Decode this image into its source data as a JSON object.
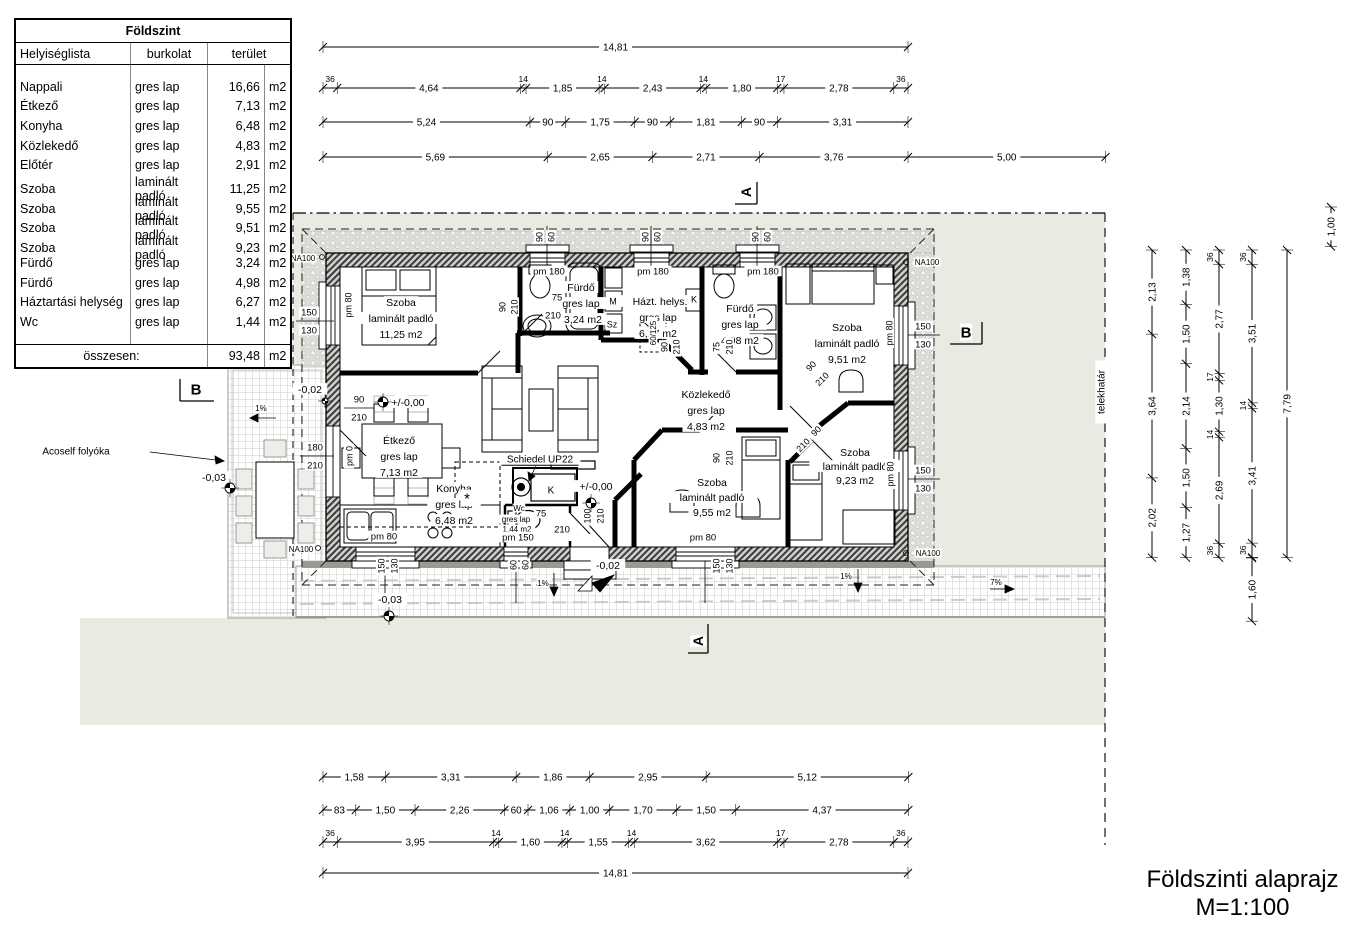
{
  "drawing": {
    "title": "Földszinti alaprajz",
    "scale_note": "M=1:100"
  },
  "schedule": {
    "title": "Földszint",
    "columns": [
      "Helyiséglista",
      "burkolat",
      "terület"
    ],
    "unit": "m2",
    "rows": [
      [
        "Nappali",
        "gres lap",
        "16,66"
      ],
      [
        "Étkező",
        "gres lap",
        "7,13"
      ],
      [
        "Konyha",
        "gres lap",
        "6,48"
      ],
      [
        "Közlekedő",
        "gres lap",
        "4,83"
      ],
      [
        "Előtér",
        "gres lap",
        "2,91"
      ],
      [
        "Szoba",
        "laminált padló",
        "11,25"
      ],
      [
        "Szoba",
        "laminált padló",
        "9,55"
      ],
      [
        "Szoba",
        "laminált padló",
        "9,51"
      ],
      [
        "Szoba",
        "laminált padló",
        "9,23"
      ],
      [
        "Fürdő",
        "gres lap",
        "3,24"
      ],
      [
        "Fürdő",
        "gres lap",
        "4,98"
      ],
      [
        "Háztartási helység",
        "gres lap",
        "6,27"
      ],
      [
        "Wc",
        "gres lap",
        "1,44"
      ]
    ],
    "total_label": "összesen:",
    "total_value": "93,48"
  },
  "colors": {
    "site": "#e9ebe2",
    "paper": "#ffffff",
    "line": "#000000"
  },
  "plan": {
    "scale_px_per_m": 39.5,
    "chains": [
      {
        "n": "top-overall",
        "d": "h",
        "x": 323,
        "y": 47,
        "segs": [
          [
            14.81,
            "14,81"
          ]
        ]
      },
      {
        "n": "top-openings",
        "d": "h",
        "x": 323,
        "y": 88,
        "segs": [
          [
            0.36,
            "36"
          ],
          [
            4.64,
            "4,64"
          ],
          [
            0.14,
            "14"
          ],
          [
            1.85,
            "1,85"
          ],
          [
            0.14,
            "14"
          ],
          [
            2.43,
            "2,43"
          ],
          [
            0.14,
            "14"
          ],
          [
            1.8,
            "1,80"
          ],
          [
            0.17,
            "17"
          ],
          [
            2.78,
            "2,78"
          ],
          [
            0.36,
            "36"
          ]
        ]
      },
      {
        "n": "top-axes",
        "d": "h",
        "x": 323,
        "y": 122,
        "segs": [
          [
            5.24,
            "5,24"
          ],
          [
            0.9,
            "90"
          ],
          [
            1.75,
            "1,75"
          ],
          [
            0.9,
            "90"
          ],
          [
            1.81,
            "1,81"
          ],
          [
            0.9,
            "90"
          ],
          [
            3.31,
            "3,31"
          ]
        ]
      },
      {
        "n": "top-site",
        "d": "h",
        "x": 323,
        "y": 157,
        "segs": [
          [
            5.69,
            "5,69"
          ],
          [
            2.65,
            "2,65"
          ],
          [
            2.71,
            "2,71"
          ],
          [
            3.76,
            "3,76"
          ],
          [
            5.0,
            "5,00"
          ]
        ]
      },
      {
        "n": "bottom-rooms",
        "d": "h",
        "x": 323,
        "y": 777,
        "segs": [
          [
            1.58,
            "1,58"
          ],
          [
            3.31,
            "3,31"
          ],
          [
            1.86,
            "1,86"
          ],
          [
            2.95,
            "2,95"
          ],
          [
            5.12,
            "5,12"
          ]
        ]
      },
      {
        "n": "bottom-openings",
        "d": "h",
        "x": 323,
        "y": 810,
        "segs": [
          [
            0.83,
            "83"
          ],
          [
            1.5,
            "1,50"
          ],
          [
            2.26,
            "2,26"
          ],
          [
            0.6,
            "60"
          ],
          [
            1.06,
            "1,06"
          ],
          [
            1.0,
            "1,00"
          ],
          [
            1.7,
            "1,70"
          ],
          [
            1.5,
            "1,50"
          ],
          [
            4.37,
            "4,37"
          ]
        ]
      },
      {
        "n": "bottom-walls",
        "d": "h",
        "x": 323,
        "y": 842,
        "segs": [
          [
            0.36,
            "36"
          ],
          [
            3.95,
            "3,95"
          ],
          [
            0.14,
            "14"
          ],
          [
            1.6,
            "1,60"
          ],
          [
            0.14,
            "14"
          ],
          [
            1.55,
            "1,55"
          ],
          [
            0.14,
            "14"
          ],
          [
            3.62,
            "3,62"
          ],
          [
            0.17,
            "17"
          ],
          [
            2.78,
            "2,78"
          ],
          [
            0.36,
            "36"
          ]
        ]
      },
      {
        "n": "bottom-overall",
        "d": "h",
        "x": 323,
        "y": 873,
        "segs": [
          [
            14.81,
            "14,81"
          ]
        ]
      },
      {
        "n": "right-1",
        "d": "v",
        "x": 1152,
        "y": 250,
        "segs": [
          [
            2.13,
            "2,13"
          ],
          [
            3.64,
            "3,64"
          ],
          [
            2.02,
            "2,02"
          ]
        ]
      },
      {
        "n": "right-2",
        "d": "v",
        "x": 1186,
        "y": 250,
        "segs": [
          [
            1.38,
            "1,38"
          ],
          [
            1.5,
            "1,50"
          ],
          [
            2.14,
            "2,14"
          ],
          [
            1.5,
            "1,50"
          ],
          [
            1.27,
            "1,27"
          ]
        ]
      },
      {
        "n": "right-3",
        "d": "v",
        "x": 1219,
        "y": 250,
        "segs": [
          [
            0.36,
            "36"
          ],
          [
            2.77,
            "2,77"
          ],
          [
            0.17,
            "17"
          ],
          [
            1.3,
            "1,30"
          ],
          [
            0.14,
            "14"
          ],
          [
            2.69,
            "2,69"
          ],
          [
            0.36,
            "36"
          ]
        ]
      },
      {
        "n": "right-4",
        "d": "v",
        "x": 1252,
        "y": 250,
        "segs": [
          [
            0.36,
            "36"
          ],
          [
            3.51,
            "3,51"
          ],
          [
            0.14,
            "14"
          ],
          [
            3.41,
            "3,41"
          ],
          [
            0.36,
            "36"
          ]
        ]
      },
      {
        "n": "right-4b",
        "d": "v",
        "x": 1252,
        "y": 558,
        "segs": [
          [
            1.6,
            "1,60"
          ]
        ]
      },
      {
        "n": "right-overall",
        "d": "v",
        "x": 1287,
        "y": 250,
        "segs": [
          [
            7.79,
            "7,79"
          ]
        ]
      },
      {
        "n": "right-top",
        "d": "v",
        "x": 1331,
        "y": 207,
        "segs": [
          [
            1.0,
            "1,00"
          ]
        ]
      }
    ],
    "labels": [
      {
        "t": "A",
        "x": 746,
        "y": 192,
        "s": 14,
        "r": -90,
        "b": 1,
        "n": "section-marker-a-top"
      },
      {
        "t": "A",
        "x": 698,
        "y": 641,
        "s": 14,
        "r": -90,
        "b": 1,
        "n": "section-marker-a-bottom"
      },
      {
        "t": "B",
        "x": 196,
        "y": 389,
        "s": 15,
        "b": 1,
        "n": "section-marker-b-left"
      },
      {
        "t": "B",
        "x": 966,
        "y": 332,
        "s": 15,
        "b": 1,
        "n": "section-marker-b-right"
      },
      {
        "t": "telekhatár",
        "x": 1101,
        "y": 392,
        "s": 10,
        "r": -90,
        "n": "plot-boundary-label"
      },
      {
        "t": "Acoself folyóka",
        "x": 76,
        "y": 451,
        "s": 10,
        "n": "drain-label"
      },
      {
        "t": "NA100",
        "x": 303,
        "y": 258,
        "s": 8
      },
      {
        "t": "NA100",
        "x": 927,
        "y": 262,
        "s": 8
      },
      {
        "t": "NA100",
        "x": 928,
        "y": 553,
        "s": 8
      },
      {
        "t": "NA100",
        "x": 301,
        "y": 549,
        "s": 8
      },
      {
        "t": "-0,03",
        "x": 214,
        "y": 477,
        "s": 10.5
      },
      {
        "t": "-0,03",
        "x": 390,
        "y": 599,
        "s": 10.5
      },
      {
        "t": "-0,02",
        "x": 310,
        "y": 389,
        "s": 10.5
      },
      {
        "t": "-0,02",
        "x": 608,
        "y": 565,
        "s": 10.5
      },
      {
        "t": "+/-0,00",
        "x": 408,
        "y": 402,
        "s": 10.5
      },
      {
        "t": "+/-0,00",
        "x": 596,
        "y": 486,
        "s": 10.5
      },
      {
        "t": "1%",
        "x": 261,
        "y": 408,
        "s": 8
      },
      {
        "t": "1%",
        "x": 543,
        "y": 583,
        "s": 8
      },
      {
        "t": "1%",
        "x": 846,
        "y": 576,
        "s": 8
      },
      {
        "t": "7%",
        "x": 996,
        "y": 582,
        "s": 8
      },
      {
        "t": "Schiedel UP22",
        "x": 540,
        "y": 459,
        "s": 10,
        "u": 1,
        "n": "chimney-label"
      },
      {
        "t": "Szoba",
        "x": 401,
        "y": 302,
        "s": 10.5,
        "n": "room-label"
      },
      {
        "t": "laminált padló",
        "x": 401,
        "y": 318,
        "s": 10.5,
        "n": "room-label"
      },
      {
        "t": "11,25 m2",
        "x": 401,
        "y": 334,
        "s": 10.5,
        "n": "room-label"
      },
      {
        "t": "Fürdő",
        "x": 581,
        "y": 287,
        "s": 10.5,
        "n": "room-label"
      },
      {
        "t": "gres lap",
        "x": 581,
        "y": 303,
        "s": 10.5,
        "n": "room-label"
      },
      {
        "t": "3,24 m2",
        "x": 583,
        "y": 319,
        "s": 10.5,
        "n": "room-label"
      },
      {
        "t": "Házt. helys.",
        "x": 660,
        "y": 301,
        "s": 10.5,
        "n": "room-label"
      },
      {
        "t": "gres lap",
        "x": 658,
        "y": 317,
        "s": 10.5,
        "n": "room-label"
      },
      {
        "t": "6,27 m2",
        "x": 658,
        "y": 333,
        "s": 10.5,
        "n": "room-label"
      },
      {
        "t": "Fürdő",
        "x": 740,
        "y": 308,
        "s": 10.5,
        "n": "room-label"
      },
      {
        "t": "gres lap",
        "x": 740,
        "y": 324,
        "s": 10.5,
        "n": "room-label"
      },
      {
        "t": "4,98 m2",
        "x": 740,
        "y": 340,
        "s": 10.5,
        "n": "room-label"
      },
      {
        "t": "Szoba",
        "x": 847,
        "y": 327,
        "s": 10.5,
        "n": "room-label"
      },
      {
        "t": "laminált padló",
        "x": 847,
        "y": 343,
        "s": 10.5,
        "n": "room-label"
      },
      {
        "t": "9,51 m2",
        "x": 847,
        "y": 359,
        "s": 10.5,
        "n": "room-label"
      },
      {
        "t": "Közlekedő",
        "x": 706,
        "y": 394,
        "s": 10.5,
        "n": "room-label"
      },
      {
        "t": "gres lap",
        "x": 706,
        "y": 410,
        "s": 10.5,
        "n": "room-label"
      },
      {
        "t": "4,83 m2",
        "x": 706,
        "y": 426,
        "s": 10.5,
        "n": "room-label"
      },
      {
        "t": "Étkező",
        "x": 399,
        "y": 440,
        "s": 10.5,
        "n": "room-label"
      },
      {
        "t": "gres lap",
        "x": 399,
        "y": 456,
        "s": 10.5,
        "n": "room-label"
      },
      {
        "t": "7,13 m2",
        "x": 399,
        "y": 472,
        "s": 10.5,
        "n": "room-label"
      },
      {
        "t": "Konyha",
        "x": 454,
        "y": 488,
        "s": 10.5,
        "n": "room-label"
      },
      {
        "t": "gres lap",
        "x": 454,
        "y": 504,
        "s": 10.5,
        "n": "room-label"
      },
      {
        "t": "6,48 m2",
        "x": 454,
        "y": 520,
        "s": 10.5,
        "n": "room-label"
      },
      {
        "t": "Wc",
        "x": 519,
        "y": 508,
        "s": 8,
        "n": "room-label"
      },
      {
        "t": "gres lap",
        "x": 516,
        "y": 519,
        "s": 8,
        "n": "room-label"
      },
      {
        "t": "1,44 m2",
        "x": 517,
        "y": 529,
        "s": 8,
        "n": "room-label"
      },
      {
        "t": "Szoba",
        "x": 712,
        "y": 482,
        "s": 10.5,
        "n": "room-label"
      },
      {
        "t": "laminált padló",
        "x": 712,
        "y": 497,
        "s": 10.5,
        "n": "room-label"
      },
      {
        "t": "9,55 m2",
        "x": 712,
        "y": 512,
        "s": 10.5,
        "n": "room-label"
      },
      {
        "t": "Szoba",
        "x": 855,
        "y": 452,
        "s": 10.5,
        "n": "room-label"
      },
      {
        "t": "laminált padló",
        "x": 855,
        "y": 466,
        "s": 10.5,
        "n": "room-label"
      },
      {
        "t": "9,23 m2",
        "x": 855,
        "y": 480,
        "s": 10.5,
        "n": "room-label"
      },
      {
        "t": "150",
        "x": 309,
        "y": 312,
        "s": 9.5
      },
      {
        "t": "130",
        "x": 309,
        "y": 330,
        "s": 9.5
      },
      {
        "t": "180",
        "x": 315,
        "y": 447,
        "s": 9.5
      },
      {
        "t": "210",
        "x": 315,
        "y": 465,
        "s": 9.5
      },
      {
        "t": "90",
        "x": 359,
        "y": 399,
        "s": 9.5
      },
      {
        "t": "210",
        "x": 359,
        "y": 417,
        "s": 9.5
      },
      {
        "t": "75",
        "x": 557,
        "y": 297,
        "s": 9.5
      },
      {
        "t": "210",
        "x": 553,
        "y": 315,
        "s": 9.5
      },
      {
        "t": "pm 180",
        "x": 549,
        "y": 271,
        "s": 9.5
      },
      {
        "t": "pm 180",
        "x": 653,
        "y": 271,
        "s": 9.5
      },
      {
        "t": "pm 180",
        "x": 763,
        "y": 271,
        "s": 9.5
      },
      {
        "t": "pm 150",
        "x": 518,
        "y": 537,
        "s": 9.5
      },
      {
        "t": "75",
        "x": 541,
        "y": 513,
        "s": 9.5
      },
      {
        "t": "210",
        "x": 562,
        "y": 529,
        "s": 9.5
      },
      {
        "t": "150",
        "x": 923,
        "y": 326,
        "s": 9.5
      },
      {
        "t": "130",
        "x": 923,
        "y": 344,
        "s": 9.5
      },
      {
        "t": "150",
        "x": 923,
        "y": 470,
        "s": 9.5
      },
      {
        "t": "130",
        "x": 923,
        "y": 488,
        "s": 9.5
      },
      {
        "t": "pm 80",
        "x": 384,
        "y": 536,
        "s": 9.5
      },
      {
        "t": "pm 80",
        "x": 703,
        "y": 537,
        "s": 9.5
      },
      {
        "t": "M",
        "x": 613,
        "y": 301,
        "s": 9
      },
      {
        "t": "Sz",
        "x": 612,
        "y": 324,
        "s": 9
      },
      {
        "t": "K",
        "x": 694,
        "y": 299,
        "s": 9
      },
      {
        "t": "K",
        "x": 551,
        "y": 490,
        "s": 10
      },
      {
        "t": "*",
        "x": 467,
        "y": 498,
        "s": 15
      },
      {
        "t": "90",
        "x": 539,
        "y": 237,
        "s": 9,
        "r": -90
      },
      {
        "t": "60",
        "x": 551,
        "y": 237,
        "s": 9,
        "r": -90
      },
      {
        "t": "90",
        "x": 645,
        "y": 237,
        "s": 9,
        "r": -90
      },
      {
        "t": "60",
        "x": 657,
        "y": 237,
        "s": 9,
        "r": -90
      },
      {
        "t": "90",
        "x": 755,
        "y": 237,
        "s": 9,
        "r": -90
      },
      {
        "t": "60",
        "x": 767,
        "y": 237,
        "s": 9,
        "r": -90
      },
      {
        "t": "pm 80",
        "x": 348,
        "y": 305,
        "s": 9,
        "r": -90
      },
      {
        "t": "pm 0",
        "x": 349,
        "y": 456,
        "s": 9,
        "r": -90
      },
      {
        "t": "90",
        "x": 502,
        "y": 307,
        "s": 9,
        "r": -90
      },
      {
        "t": "210",
        "x": 514,
        "y": 307,
        "s": 9,
        "r": -90
      },
      {
        "t": "90",
        "x": 664,
        "y": 347,
        "s": 9,
        "r": -90
      },
      {
        "t": "210",
        "x": 676,
        "y": 347,
        "s": 9,
        "r": -90
      },
      {
        "t": "60/125",
        "x": 653,
        "y": 333,
        "s": 8,
        "r": -90
      },
      {
        "t": "75",
        "x": 716,
        "y": 347,
        "s": 9,
        "r": -90
      },
      {
        "t": "210",
        "x": 729,
        "y": 347,
        "s": 9,
        "r": -90
      },
      {
        "t": "90",
        "x": 716,
        "y": 458,
        "s": 9,
        "r": -90
      },
      {
        "t": "210",
        "x": 729,
        "y": 458,
        "s": 9,
        "r": -90
      },
      {
        "t": "100",
        "x": 587,
        "y": 516,
        "s": 9,
        "r": -90
      },
      {
        "t": "210",
        "x": 600,
        "y": 516,
        "s": 9,
        "r": -90
      },
      {
        "t": "pm 80",
        "x": 889,
        "y": 333,
        "s": 9,
        "r": -90
      },
      {
        "t": "pm 80",
        "x": 890,
        "y": 474,
        "s": 9,
        "r": -90
      },
      {
        "t": "150",
        "x": 381,
        "y": 566,
        "s": 9,
        "r": -90
      },
      {
        "t": "130",
        "x": 394,
        "y": 566,
        "s": 9,
        "r": -90
      },
      {
        "t": "60",
        "x": 513,
        "y": 565,
        "s": 9,
        "r": -90
      },
      {
        "t": "60",
        "x": 525,
        "y": 565,
        "s": 9,
        "r": -90
      },
      {
        "t": "150",
        "x": 716,
        "y": 566,
        "s": 9,
        "r": -90
      },
      {
        "t": "130",
        "x": 729,
        "y": 566,
        "s": 9,
        "r": -90
      },
      {
        "t": "90",
        "x": 811,
        "y": 366,
        "s": 9,
        "r": -45
      },
      {
        "t": "210",
        "x": 822,
        "y": 379,
        "s": 9,
        "r": -45
      },
      {
        "t": "90",
        "x": 816,
        "y": 431,
        "s": 9,
        "r": -45
      },
      {
        "t": "210",
        "x": 803,
        "y": 445,
        "s": 9,
        "r": -45
      }
    ],
    "level_markers": [
      {
        "x": 383,
        "y": 402
      },
      {
        "x": 591,
        "y": 503
      },
      {
        "x": 230,
        "y": 488
      },
      {
        "x": 389,
        "y": 616
      },
      {
        "x": 325,
        "y": 401,
        "small": true
      }
    ]
  }
}
